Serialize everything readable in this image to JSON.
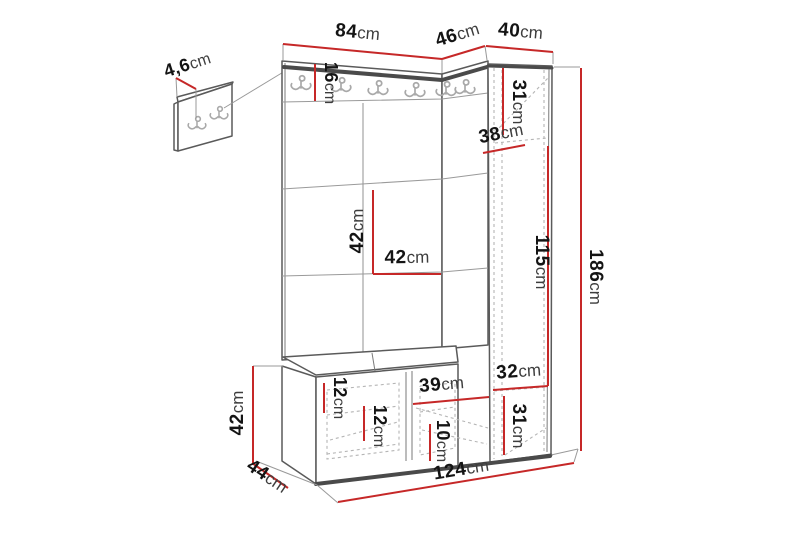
{
  "unit": "cm",
  "colors": {
    "dimension_line": "#c62828",
    "outline": "#5a5a5a",
    "dark_edge": "#4a4a4a",
    "label_number": "#141414",
    "label_unit": "#3d3d3d"
  },
  "icons": {
    "coat_hook": "double-coat-hook-icon"
  },
  "dimensions": {
    "panel_thickness": {
      "value": "4,6",
      "unit": "cm"
    },
    "top_width": {
      "value": "84",
      "unit": "cm"
    },
    "corner_width": {
      "value": "46",
      "unit": "cm"
    },
    "cabinet_width": {
      "value": "40",
      "unit": "cm"
    },
    "hook_rail_height": {
      "value": "16",
      "unit": "cm"
    },
    "cabinet_top_height": {
      "value": "31",
      "unit": "cm"
    },
    "corner_depth": {
      "value": "38",
      "unit": "cm"
    },
    "panel_tile_height": {
      "value": "42",
      "unit": "cm"
    },
    "panel_tile_width": {
      "value": "42",
      "unit": "cm"
    },
    "cabinet_inner_height": {
      "value": "115",
      "unit": "cm"
    },
    "total_height": {
      "value": "186",
      "unit": "cm"
    },
    "cabinet_bottom_width": {
      "value": "32",
      "unit": "cm"
    },
    "cabinet_bottom_height": {
      "value": "31",
      "unit": "cm"
    },
    "bench_height": {
      "value": "42",
      "unit": "cm"
    },
    "bench_depth": {
      "value": "44",
      "unit": "cm"
    },
    "bench_drawer_height": {
      "value": "12",
      "unit": "cm"
    },
    "bench_inner_height": {
      "value": "12",
      "unit": "cm"
    },
    "bench_compartment_width": {
      "value": "39",
      "unit": "cm"
    },
    "bench_shelf_height": {
      "value": "10",
      "unit": "cm"
    },
    "total_width": {
      "value": "124",
      "unit": "cm"
    }
  }
}
